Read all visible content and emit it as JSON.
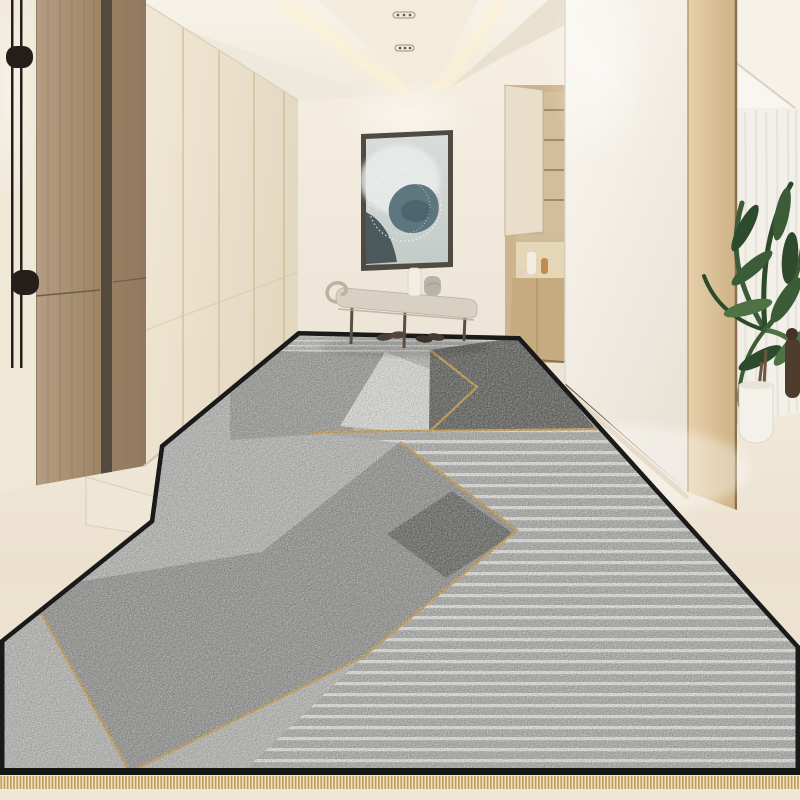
{
  "alt_text": "Modern beige hallway entry with wood wardrobe doors, abstract framed art over a bench with shoes, built-in shelf niche, wood pillar, potted palm by sheer curtains, and a long geometric grey runner rug with gold trim lines, stripes and a black border with gold fringe.",
  "scene": {
    "ceiling": {
      "spotlight_count": 2,
      "cove_lighting": true
    },
    "left_wall": {
      "lamp_rod_count": 2,
      "lamp_knob_count": 2,
      "closet_panel_seams": 4
    },
    "back_wall": {
      "artwork_count": 1,
      "bench_leg_count": 3,
      "shoe_pair_count": 2,
      "bench_item_count": 2
    },
    "niche": {
      "shelf_count": 4,
      "decor_item_count": 3
    },
    "side_room": {
      "plant_count": 1,
      "pot_count": 1,
      "sculpture_count": 1
    },
    "rug": {
      "stripe_zones": 2,
      "gold_trim_lines": 7,
      "fringe_edge": "bottom",
      "border": "black"
    }
  },
  "colors": {
    "ceiling_white": "#f4efe5",
    "ceiling_tray": "#f3ecdd",
    "ceiling_side": "#e9e1d0",
    "ceiling_glow": "#fff3d2",
    "spot_slot": "#efe9db",
    "spot_dot": "#5f574c",
    "wall_left_strip": "#f0e8d7",
    "fixture_black": "#241f1b",
    "wood_door_dark_seam": "#554a3e",
    "wood_door_side": "#967e66",
    "closet_seam": "#c8b28a",
    "sill_cream": "#eee6d6",
    "niche_cream": "#e9dec9",
    "niche_wood": "#cdb48d",
    "niche_shelf_line": "#8f7a5c",
    "niche_cabinet": "#c7ab80",
    "vase_white": "#f1ede3",
    "amber_bottle": "#c08b4e",
    "baseboard": "#6d5e4c",
    "painting_frame": "#4f4b43",
    "painting_teal": "#567179",
    "painting_teal_dark": "#46626a",
    "painting_dark": "#3e4d51",
    "painting_light": "#e9edeb",
    "bench": "#d8d0c2",
    "bench_leg": "#5c4f41",
    "towel_gray": "#b8b3aa",
    "shoe_dark1": "#4a3e36",
    "shoe_dark2": "#3c332c",
    "floor_shadow": "#d8ccb8",
    "curtain": "#f1eee7",
    "window_glow": "#ffffff",
    "plant_dark": "#2d4a2c",
    "plant_mid": "#3c5c38",
    "plant_light": "#4f7245",
    "trunk_brown": "#6b5640",
    "pot_white": "#f3f1ea",
    "sculpture_brown": "#4e3c2d",
    "rug_light": "#b4b4b2",
    "rug_medium": "#9a9a97",
    "rug_medium2": "#929290",
    "rug_medium_big": "#939391",
    "rug_dark": "#62625f",
    "rug_dark2": "#6a6a67",
    "rug_white_zone": "#d7d7d3",
    "gold": "#c49a4a",
    "fringe_gold": "#c09a4e",
    "rug_border": "#1a1a1a"
  }
}
